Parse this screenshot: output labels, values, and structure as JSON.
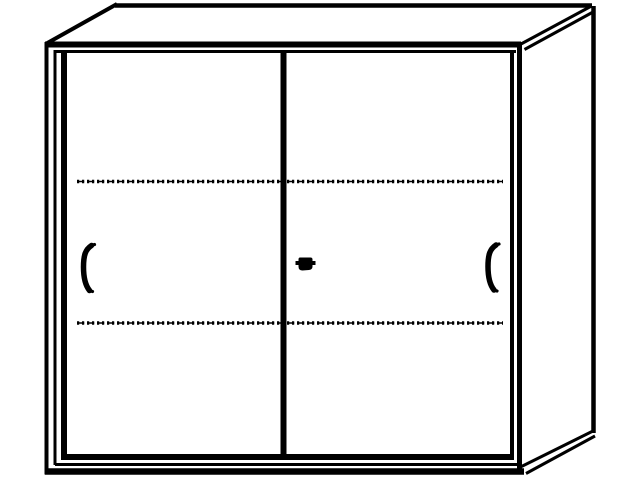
{
  "figure": {
    "background_color": "#ffffff",
    "line_color": "#000000",
    "parts": [
      {
        "name": "top-panel"
      },
      {
        "name": "right-side-panel"
      },
      {
        "name": "left-sliding-door"
      },
      {
        "name": "right-sliding-door"
      },
      {
        "name": "left-door-handle"
      },
      {
        "name": "right-door-handle"
      },
      {
        "name": "lock-cylinder"
      },
      {
        "name": "upper-shelf-dashed-line"
      },
      {
        "name": "lower-shelf-dashed-line"
      }
    ]
  }
}
